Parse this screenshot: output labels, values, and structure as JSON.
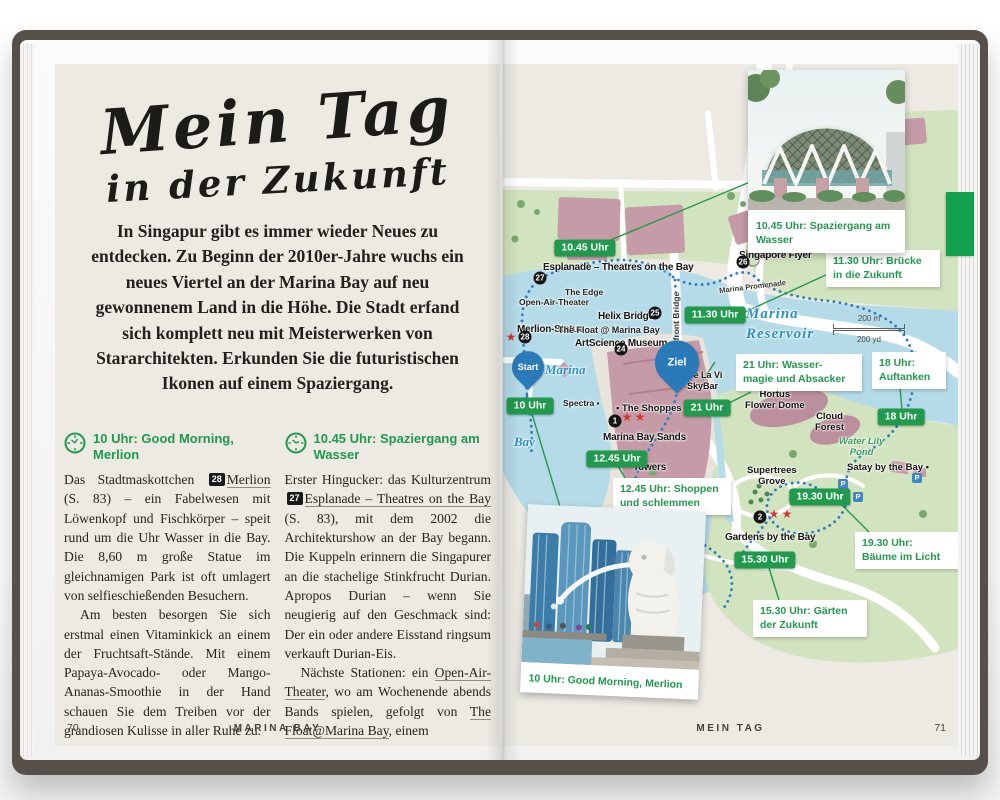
{
  "colors": {
    "green": "#21994e",
    "page": "#edeae4",
    "water": "#b5dbe9",
    "park": "#d2e4bf",
    "building": "#c49ba7",
    "route": "#2f7dc1",
    "ink": "#26241f"
  },
  "left_page": {
    "title": {
      "line1": "Mein Tag",
      "line2": "in der Zukunft"
    },
    "intro": "In Singapur gibt es immer wieder Neues zu entdecken. Zu Beginn der 2010er-Jahre wuchs ein neues Viertel an der Marina Bay auf neu gewonnenem Land in die Höhe. Die Stadt erfand sich komplett neu mit Meisterwerken von Stararchitekten. Erkunden Sie die futuristischen Ikonen auf einem Spaziergang.",
    "columns": [
      {
        "heading": "10 Uhr: Good Morning, Merlion",
        "paragraphs": [
          {
            "indent": false,
            "segments": [
              {
                "t": "text",
                "v": "Das Stadtmaskottchen "
              },
              {
                "t": "badge",
                "v": "28"
              },
              {
                "t": "link",
                "v": "Merlion"
              },
              {
                "t": "text",
                "v": " (S. 83) – ein Fabelwesen mit Löwenkopf und Fischkörper – speit rund um die Uhr Wasser in die Bay. Die 8,60 m große Statue im gleichnamigen Park ist oft umlagert von selfieschießenden Besuchern."
              }
            ]
          },
          {
            "indent": true,
            "segments": [
              {
                "t": "text",
                "v": "Am besten besorgen Sie sich erstmal einen Vitaminkick an einem der Fruchtsaft-Stände. Mit einem Papaya-Avocado- oder Mango-Ananas-Smoothie in der Hand schauen Sie dem Treiben vor der grandiosen Kulisse in aller Ruhe zu."
              }
            ]
          }
        ]
      },
      {
        "heading": "10.45 Uhr: Spaziergang am Wasser",
        "paragraphs": [
          {
            "indent": false,
            "segments": [
              {
                "t": "text",
                "v": "Erster Hingucker: das Kulturzentrum "
              },
              {
                "t": "badge",
                "v": "27"
              },
              {
                "t": "link",
                "v": "Esplanade – Theatres on the Bay"
              },
              {
                "t": "text",
                "v": " (S. 83), mit dem 2002 die Architekturshow an der Bay begann. Die Kuppeln erinnern die Singapurer an die stachelige Stinkfrucht Durian. Apropos Durian – wenn Sie neugierig auf den Geschmack sind: Der ein oder andere Eisstand ringsum verkauft Durian-Eis."
              }
            ]
          },
          {
            "indent": true,
            "segments": [
              {
                "t": "text",
                "v": "Nächste Stationen: ein "
              },
              {
                "t": "link",
                "v": "Open-Air-Theater"
              },
              {
                "t": "text",
                "v": ", wo am Wochenende abends Bands spielen, gefolgt von "
              },
              {
                "t": "link",
                "v": "The Float@Marina Bay"
              },
              {
                "t": "text",
                "v": ", einem"
              }
            ]
          }
        ]
      }
    ],
    "footer": {
      "page_number": "70",
      "chapter": "MARINA BAY"
    }
  },
  "right_page": {
    "photos": [
      {
        "id": "esplanade",
        "caption": "10.45 Uhr: Spaziergang am Wasser"
      },
      {
        "id": "merlion",
        "caption": "10 Uhr: Good Morning, Merlion"
      }
    ],
    "map": {
      "pills": [
        {
          "t": "10.45 Uhr",
          "x": 82,
          "y": 184
        },
        {
          "t": "11.30 Uhr",
          "x": 212,
          "y": 251
        },
        {
          "t": "10 Uhr",
          "x": 27,
          "y": 342
        },
        {
          "t": "21 Uhr",
          "x": 204,
          "y": 344
        },
        {
          "t": "12.45 Uhr",
          "x": 114,
          "y": 395
        },
        {
          "t": "18 Uhr",
          "x": 398,
          "y": 353
        },
        {
          "t": "19.30 Uhr",
          "x": 317,
          "y": 433
        },
        {
          "t": "15.30 Uhr",
          "x": 262,
          "y": 496
        }
      ],
      "callouts": [
        {
          "t": "11.30 Uhr: Brücke\nin die Zukunft",
          "x": 323,
          "y": 186,
          "w": 100
        },
        {
          "t": "21 Uhr: Wasser-\nmagie und Absacker",
          "x": 233,
          "y": 290,
          "w": 112
        },
        {
          "t": "18 Uhr:\nAuftanken",
          "x": 369,
          "y": 288,
          "w": 60
        },
        {
          "t": "19.30 Uhr:\nBäume im Licht",
          "x": 352,
          "y": 468,
          "w": 90
        },
        {
          "t": "15.30 Uhr: Gärten\nder Zukunft",
          "x": 250,
          "y": 536,
          "w": 100
        },
        {
          "t": "12.45 Uhr: Shoppen\nund schlemmen",
          "x": 110,
          "y": 414,
          "w": 104
        }
      ],
      "labels": [
        {
          "t": "Esplanade – Theatres on the Bay",
          "x": 40,
          "y": 198,
          "c": "lb-bold"
        },
        {
          "t": "Singapore Flyer",
          "x": 236,
          "y": 186,
          "c": "lb-bold"
        },
        {
          "t": "Helix Bridge",
          "x": 95,
          "y": 247,
          "c": "lb-bold"
        },
        {
          "t": "ArtScience Museum",
          "x": 72,
          "y": 274,
          "c": "lb-bold"
        },
        {
          "t": "Merlion-Statue",
          "x": 14,
          "y": 260,
          "c": "lb-bold"
        },
        {
          "t": "▪ The Shoppes",
          "x": 113,
          "y": 339,
          "c": "lb-bold-sm"
        },
        {
          "t": "Marina Bay Sands",
          "x": 100,
          "y": 368,
          "c": "lb-bold"
        },
        {
          "t": "Towers",
          "x": 130,
          "y": 398,
          "c": "lb-bold"
        },
        {
          "t": "Gardens by the Bay",
          "x": 222,
          "y": 468,
          "c": "lb-bold"
        },
        {
          "t": "Hortus\nFlower Dome",
          "x": 242,
          "y": 326,
          "c": "lb-bold-c"
        },
        {
          "t": "Cloud\nForest",
          "x": 312,
          "y": 348,
          "c": "lb-bold-c"
        },
        {
          "t": "Satay by the Bay ▪",
          "x": 344,
          "y": 398,
          "c": "lb-bold-sm"
        },
        {
          "t": "Supertrees\nGrove",
          "x": 244,
          "y": 402,
          "c": "lb-bold-c"
        },
        {
          "t": "Cé La Vi\nSkyBar",
          "x": 184,
          "y": 306,
          "c": "lb-sm2"
        },
        {
          "t": "The Edge",
          "x": 62,
          "y": 223,
          "c": "lb-small"
        },
        {
          "t": "Open-Air-Theater",
          "x": 16,
          "y": 233,
          "c": "lb-small"
        },
        {
          "t": "The Float @ Marina Bay",
          "x": 55,
          "y": 261,
          "c": "lb-small2"
        },
        {
          "t": "Spectra ▪",
          "x": 60,
          "y": 334,
          "c": "lb-small"
        },
        {
          "t": "Marina",
          "x": 42,
          "y": 298,
          "c": "lb-water"
        },
        {
          "t": "Bay",
          "x": 11,
          "y": 370,
          "c": "lb-water"
        },
        {
          "t": "Marina\nReservoir",
          "x": 243,
          "y": 240,
          "c": "lb-water-lg"
        },
        {
          "t": "Water Lily\nPond",
          "x": 336,
          "y": 372,
          "c": "lb-pond"
        },
        {
          "t": "Marina  Promenade",
          "x": 216,
          "y": 218,
          "c": "lb-road"
        },
        {
          "t": "Bayfront Bridge",
          "x": 168,
          "y": 292,
          "c": "lb-vert"
        }
      ],
      "badges": [
        {
          "n": "27",
          "x": 37,
          "y": 214
        },
        {
          "n": "26",
          "x": 240,
          "y": 198
        },
        {
          "n": "25",
          "x": 152,
          "y": 249
        },
        {
          "n": "24",
          "x": 118,
          "y": 285
        },
        {
          "n": "28",
          "x": 22,
          "y": 273
        },
        {
          "n": "1",
          "x": 112,
          "y": 357
        },
        {
          "n": "2",
          "x": 257,
          "y": 453
        }
      ],
      "stars": [
        {
          "x": 124,
          "y": 353
        },
        {
          "x": 137,
          "y": 353
        },
        {
          "x": 271,
          "y": 450
        },
        {
          "x": 284,
          "y": 450
        },
        {
          "x": 8,
          "y": 273
        }
      ],
      "parking": [
        {
          "x": 340,
          "y": 420
        },
        {
          "x": 355,
          "y": 433
        },
        {
          "x": 414,
          "y": 414
        },
        {
          "x": 174,
          "y": 530
        }
      ],
      "markers": {
        "start": {
          "t": "Start",
          "x": 25,
          "y": 316
        },
        "ziel": {
          "t": "Ziel",
          "x": 174,
          "y": 316
        }
      },
      "scale": {
        "m": "200 m",
        "yd": "200 yd",
        "x": 330,
        "y": 250
      }
    },
    "footer": {
      "chapter": "MEIN TAG",
      "page_number": "71"
    }
  }
}
